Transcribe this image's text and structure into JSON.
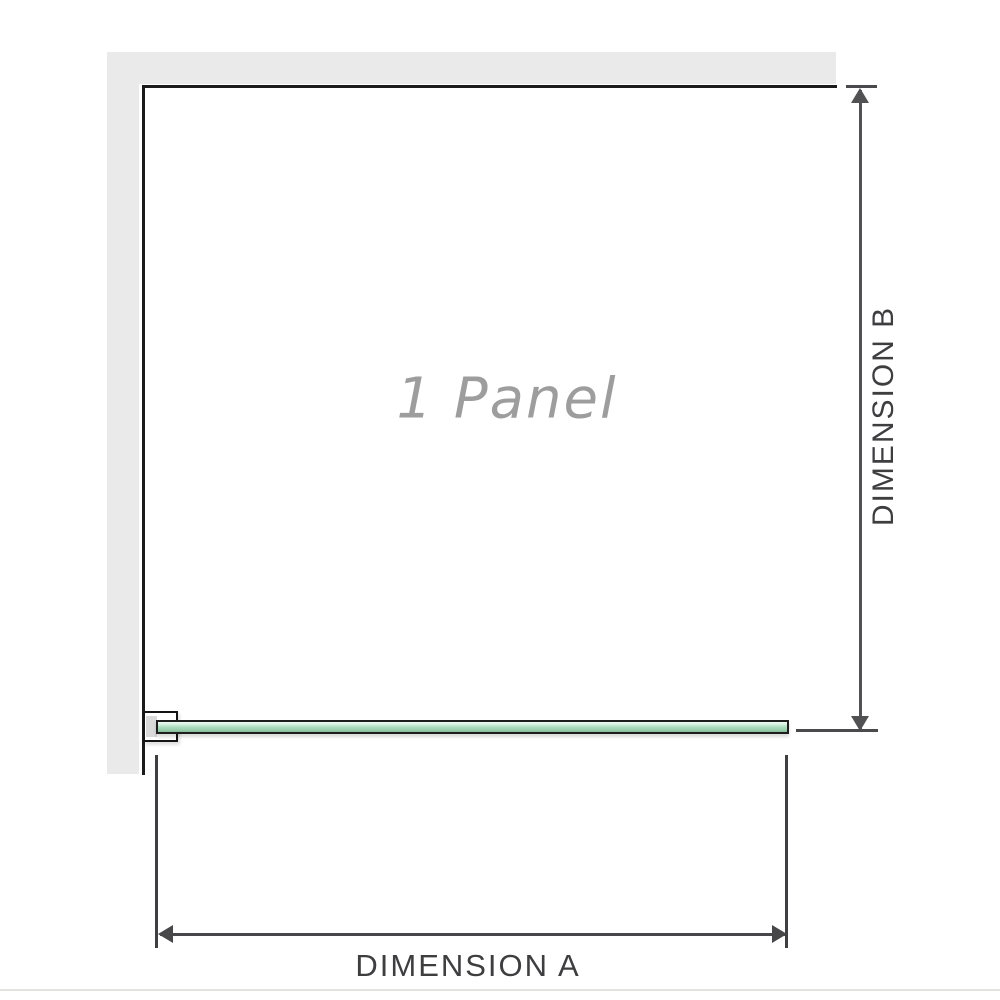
{
  "diagram": {
    "watermark_label": "1 Panel",
    "dimension_a": {
      "label": "DIMENSION A"
    },
    "dimension_b": {
      "label": "DIMENSION B"
    },
    "icons": {
      "arrowhead_up": "triangle-up",
      "arrowhead_down": "triangle-down",
      "arrowhead_left": "triangle-left",
      "arrowhead_right": "triangle-right"
    },
    "colors": {
      "background": "#ffffff",
      "wall_fill": "#eaeaea",
      "wall_edge_line": "#1b1b1b",
      "glass_fill_light": "#d6f0e0",
      "glass_fill": "#a9dabd",
      "glass_border": "#1d1d1d",
      "bracket_fill": "#ffffff",
      "bracket_anchor_block": "#d9d9d9",
      "dimension_line": "#4a4a4d",
      "dimension_text": "#3e3e40",
      "watermark_text": "#9d9d9d",
      "bottom_divider": "#e2e2df"
    }
  }
}
